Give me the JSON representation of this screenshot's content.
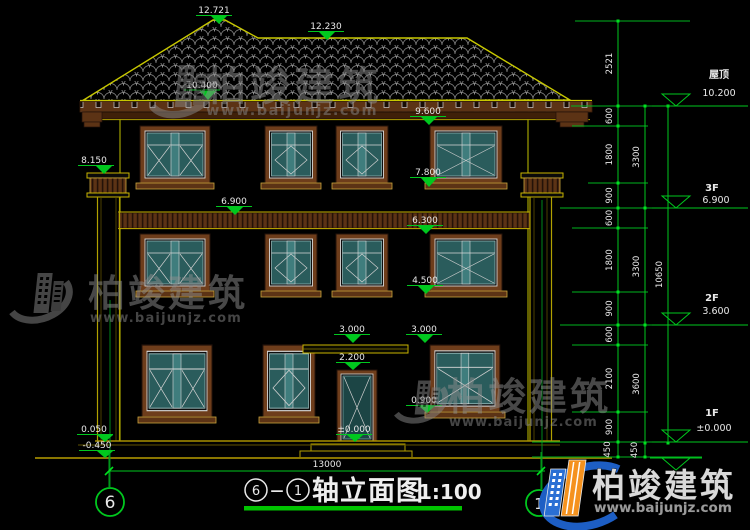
{
  "drawing": {
    "title": {
      "axis_from": "6",
      "axis_sep": "—",
      "axis_to": "1",
      "name": "轴立面图",
      "scale": "1:100"
    },
    "bottom": {
      "overall_dim": "13000",
      "axis_left": "6",
      "axis_right": "1"
    },
    "facade_levels": {
      "peak": "12.721",
      "ridge": "12.230",
      "left_upper": "10.400",
      "chimney": "8.150",
      "eave": "9.600",
      "sill_3f": "7.800",
      "floor_3f": "6.900",
      "win_top_2f": "6.300",
      "sill_2f": "4.500",
      "canopy": "3.000",
      "win_top_1f": "3.000",
      "door_top": "2.200",
      "sill_1f": "0.900",
      "zero": "±0.000",
      "plinth": "0.050",
      "ground": "-0.450"
    },
    "right_levels": {
      "roof_label": "屋顶",
      "roof_value": "10.200",
      "f3_label": "3F",
      "f3_value": "6.900",
      "f2_label": "2F",
      "f2_value": "3.600",
      "f1_label": "1F",
      "f1_value": "±0.000"
    },
    "dim_chain_inner": [
      "2521",
      "600",
      "1800",
      "900",
      "600",
      "1800",
      "900",
      "600",
      "2100",
      "900",
      "450"
    ],
    "dim_chain_mid": [
      "3300",
      "3300",
      "3600",
      "450"
    ],
    "dim_chain_outer": [
      "10650"
    ]
  },
  "watermark": {
    "brand": "柏竣建筑",
    "url": "www.baijunjz.com"
  },
  "colors": {
    "dim_green": "#00c81e",
    "outline_yellow": "#c8c800",
    "wood_brown": "#5c3315",
    "glass_teal": "#2a5c5c",
    "logo_blue": "#2a6fd4",
    "logo_orange": "#f5921e"
  }
}
